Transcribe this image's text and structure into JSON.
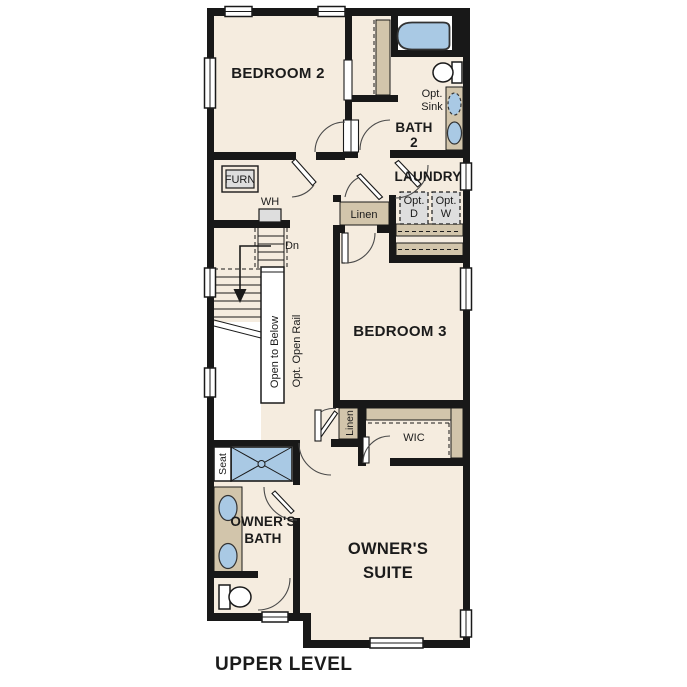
{
  "title": "UPPER LEVEL",
  "colors": {
    "floor": "#f5ecdf",
    "wall": "#181818",
    "shelf": "#d2c5ab",
    "blue": "#a9c9e4",
    "equip": "#dedede",
    "line": "#1a1a1a"
  },
  "rooms": {
    "bedroom2": {
      "label": "BEDROOM 2"
    },
    "bath2": {
      "label_line1": "BATH",
      "label_line2": "2"
    },
    "laundry": {
      "label": "LAUNDRY"
    },
    "bedroom3": {
      "label": "BEDROOM 3"
    },
    "wic": {
      "label": "WIC"
    },
    "owners_bath": {
      "label_line1": "OWNER'S",
      "label_line2": "BATH"
    },
    "owners_suite": {
      "label_line1": "OWNER'S",
      "label_line2": "SUITE"
    }
  },
  "annotations": {
    "furnace": "FURN",
    "water_heater": "WH",
    "down": "Dn",
    "open_to_below": "Open to Below",
    "opt_open_rail": "Opt. Open Rail",
    "linen_upper": "Linen",
    "linen_lower": "Linen",
    "seat": "Seat",
    "opt_sink_line1": "Opt.",
    "opt_sink_line2": "Sink",
    "opt_dryer_line1": "Opt.",
    "opt_dryer_line2": "D",
    "opt_washer_line1": "Opt.",
    "opt_washer_line2": "W"
  }
}
